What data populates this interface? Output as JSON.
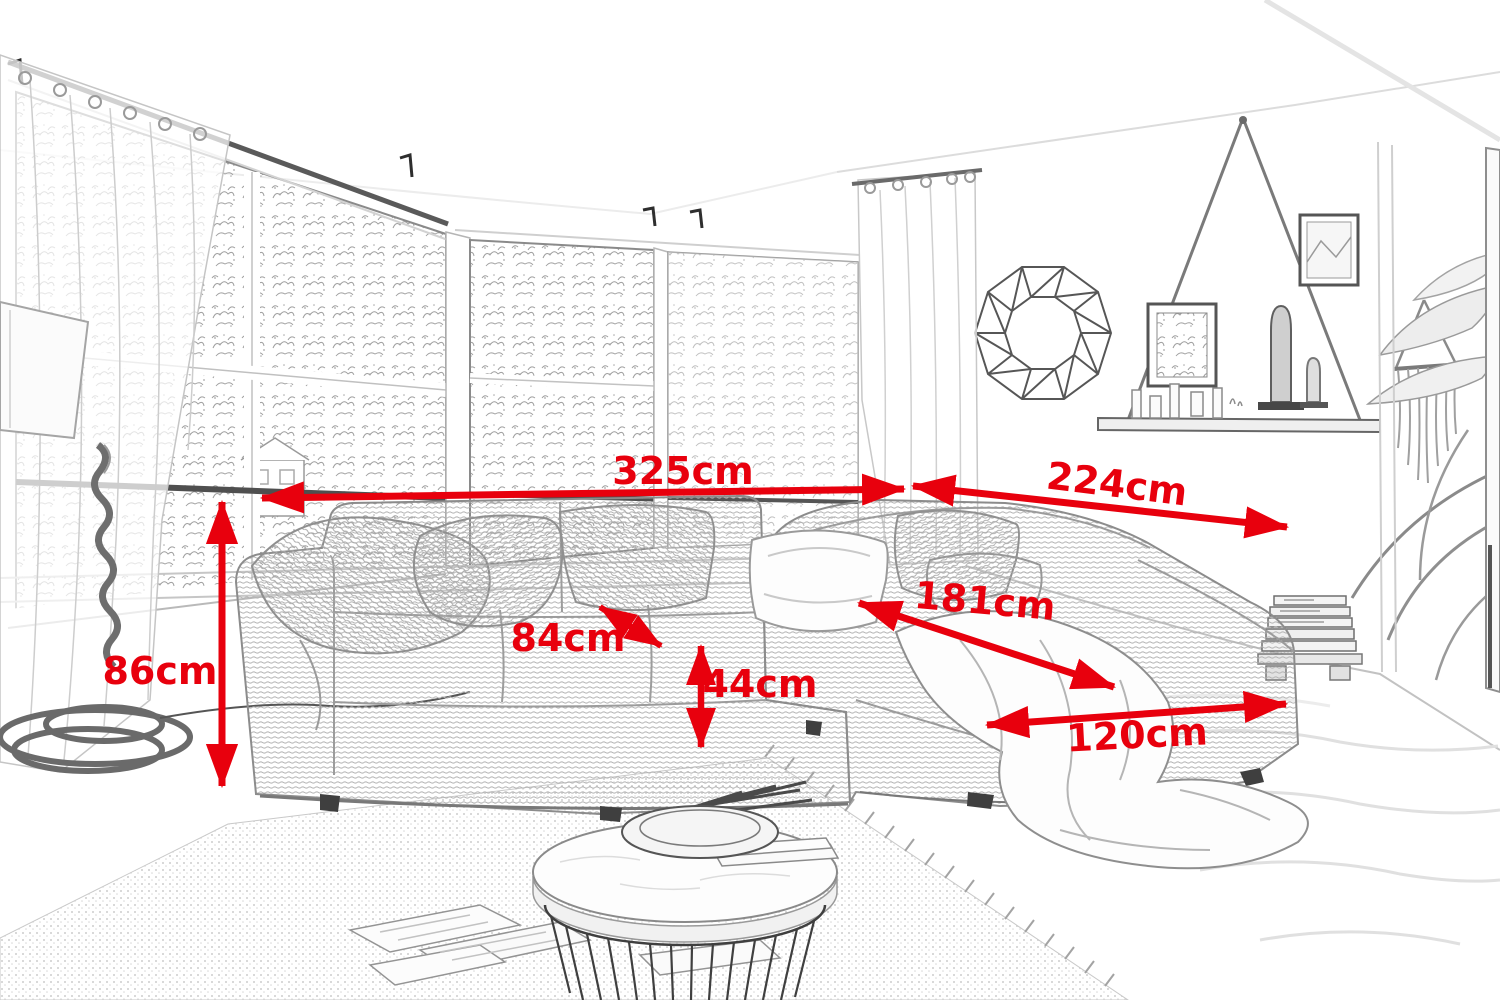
{
  "annotation_color": "#e8000d",
  "dimensions": {
    "total_width": {
      "label": "325cm"
    },
    "right_side_depth": {
      "label": "224cm"
    },
    "back_height": {
      "label": "86cm"
    },
    "seat_depth": {
      "label": "84cm"
    },
    "seat_height": {
      "label": "44cm"
    },
    "chaise_length": {
      "label": "181cm"
    },
    "chaise_width": {
      "label": "120cm"
    }
  },
  "sketch_objects": [
    "corner-sofa",
    "throw-pillows",
    "throw-blanket",
    "corner-windows-with-trees",
    "sheer-curtains",
    "rope-floor-lamp",
    "geometric-wall-mirror",
    "hanging-rope-shelf-with-frames-and-figurines",
    "framed-wall-picture",
    "macrame-wall-hanging",
    "palm-plant",
    "stacked-magazines-on-mini-pallet",
    "jute-rug",
    "white-rug",
    "round-wire-frame-coffee-table-with-marble-top",
    "bowl-with-sticks",
    "magazines-on-floor"
  ]
}
